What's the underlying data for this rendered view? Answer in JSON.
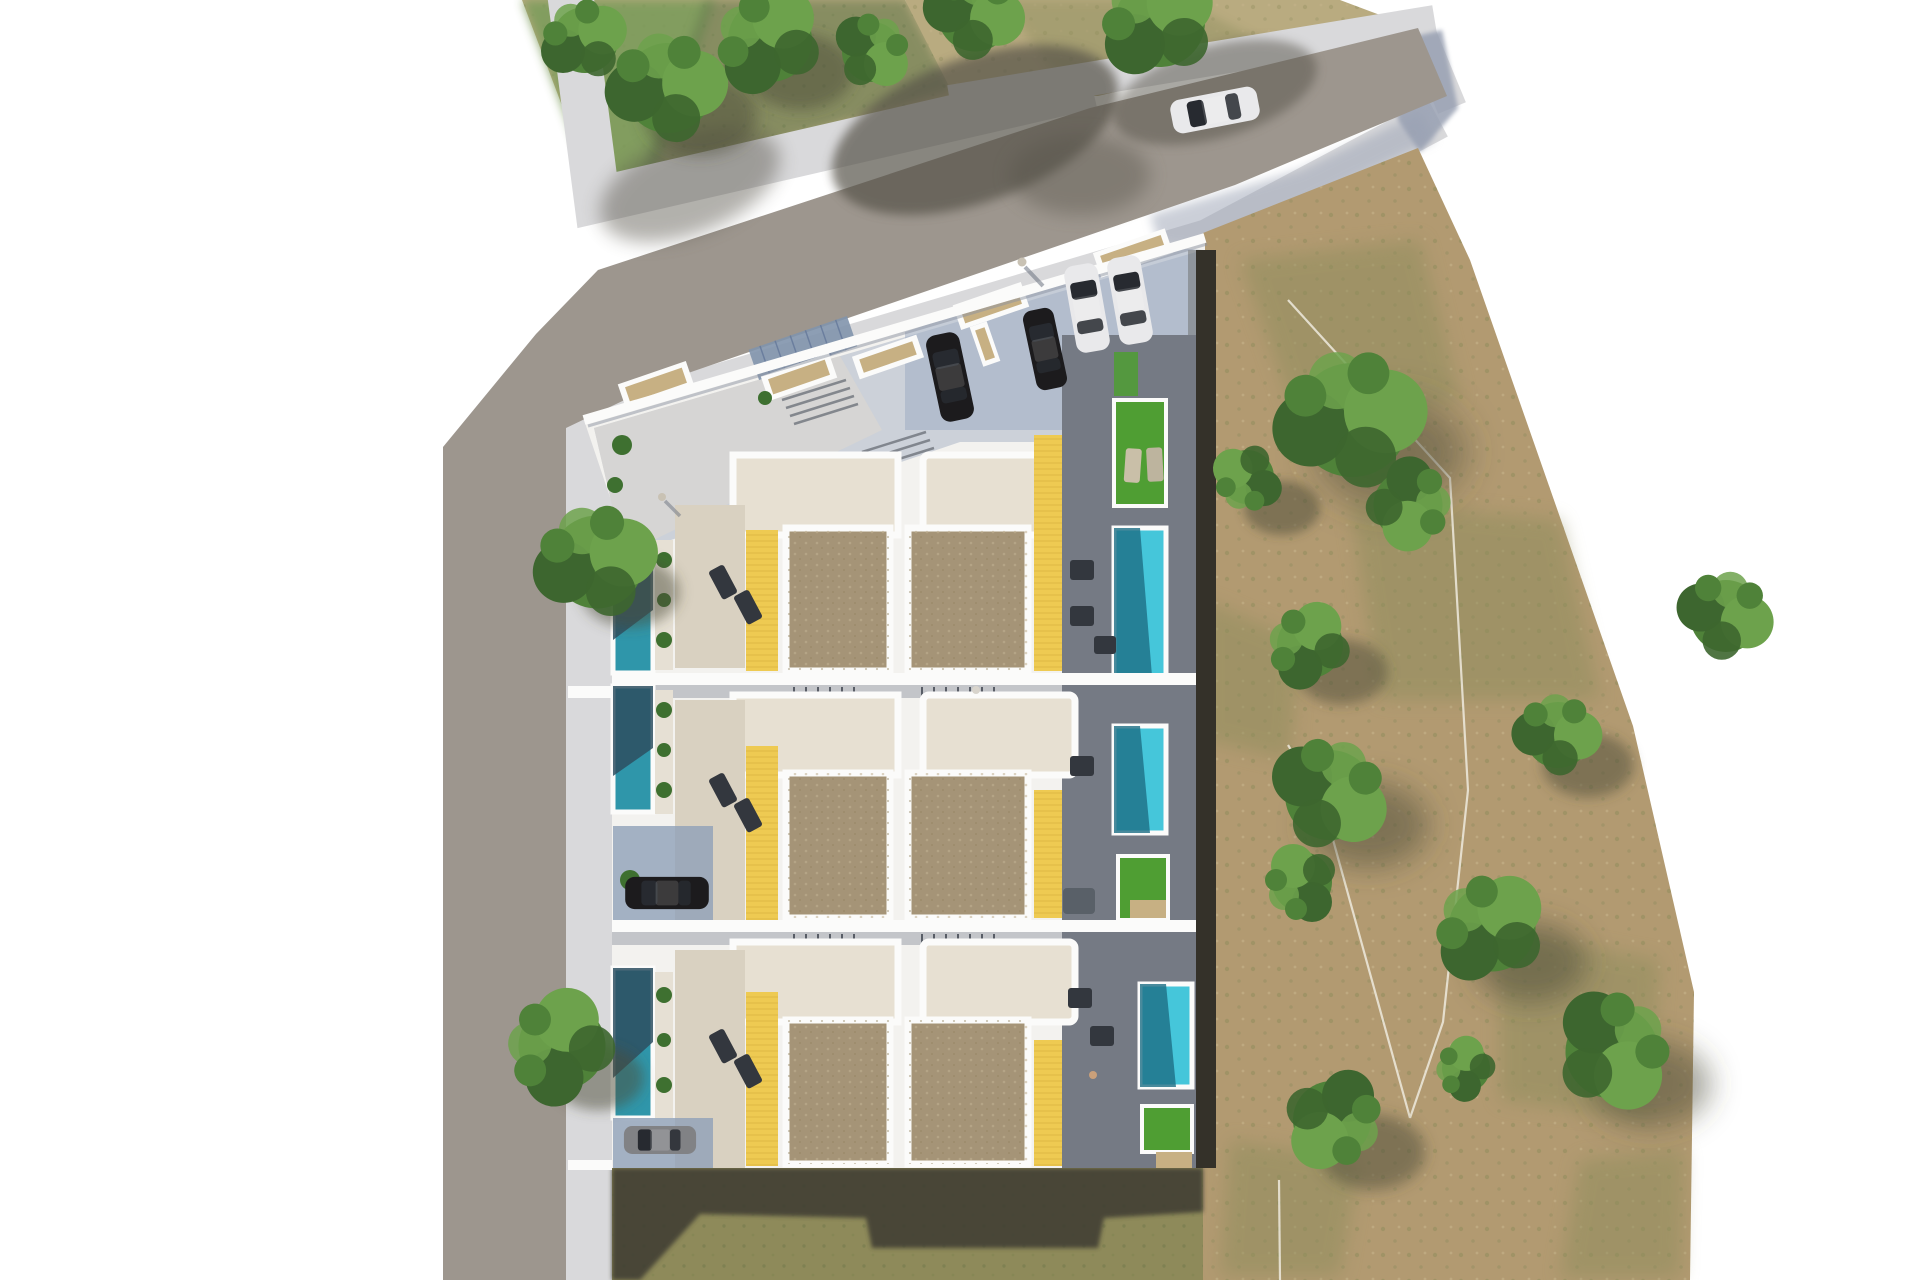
{
  "scene": {
    "title": "Aerial top-down architectural render of a residential villa development site plan",
    "description": "Photorealistic bird's-eye rendering: six attached villas in three rows with private pools, yellow pergola decks, roof terraces, a corner parking plaza with cars, surrounding streets with sidewalks, a green tree parcel at top-left and a large dry-dirt field with scattered trees on the right."
  },
  "inventory": {
    "villas": 6,
    "villa_rows": 3,
    "pools_left_column": 3,
    "pools_right_column": 3,
    "lawn_patches": 4,
    "parking_area_cars": 4,
    "driveway_cars": 2,
    "cars_on_road": 1,
    "field_trees": 11,
    "parcel_trees": 6,
    "street_trees": 3,
    "people": 4
  },
  "colors": {
    "background": "#ffffff",
    "road": "#9d968e",
    "road_shadow": "#565349",
    "sidewalk": "#d9d9db",
    "sidewalk_shadow": "#98a0b2",
    "plaza_tile": "#ccd1d9",
    "plaza_tile_blue": "#9fadc2",
    "crosswalk_panel": "#8194ac",
    "grass_green": "#7d9c5c",
    "grass_dark": "#5e754a",
    "dry_grass": "#b9ab80",
    "dry_olive": "#8f8f5f",
    "dirt": "#b29a71",
    "dirt_olive": "#8d8c5c",
    "dirt_shadow": "#66603f",
    "bottom_grass": "#8e8a5a",
    "bottom_grass_shadow": "#3c3a31",
    "tree_dark": "#3d662f",
    "tree_mid": "#4f8239",
    "tree_light": "#6da24c",
    "tree_shadow": "#4c4a38",
    "site_base": "#f3f2ef",
    "wall_white": "#fbfbfa",
    "wall_shade": "#9aa0aa",
    "upper_terrace": "#e7e0d2",
    "ground_terrace": "#d9d1c1",
    "roof_brown": "#a59477",
    "roof_speckle": "#c0b092",
    "deck_yellow": "#eeca52",
    "deck_line": "#c7a232",
    "pool_teal": "#2f96aa",
    "pool_teal_dark": "#2d4f60",
    "pool_cyan": "#45c6da",
    "pool_cyan_dark": "#1d6e85",
    "lawn": "#4f9e33",
    "shadow_terrace": "#757a84",
    "furniture_dark": "#33373e",
    "sofa_gray": "#596068",
    "hedge_dark": "#343129",
    "path_beige": "#d8cdb4",
    "planter_gravel": "#c7b083",
    "plant_green": "#3e7030",
    "car_dark": "#1c1b1d",
    "car_white": "#e9e9eb",
    "car_gray": "#818285",
    "car_glass": "#272a30",
    "person": "#c9c2b4"
  }
}
